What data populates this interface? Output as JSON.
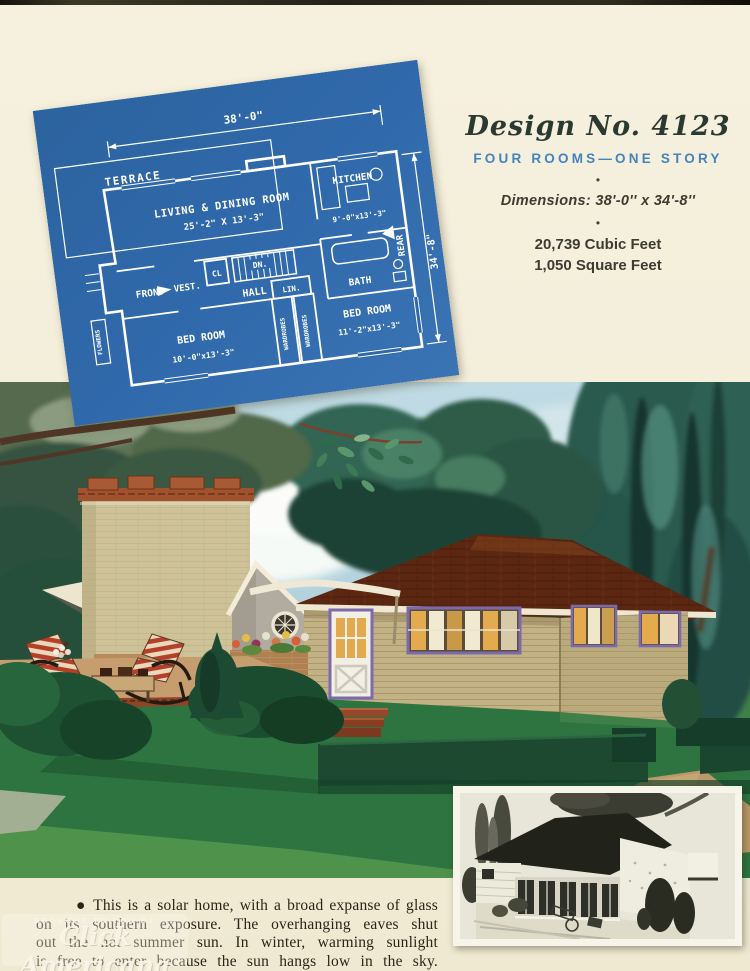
{
  "design_info": {
    "title": "Design No. 4123",
    "subtitle": "FOUR ROOMS—ONE STORY",
    "bullet": "•",
    "dimensions": "Dimensions: 38'-0'' x 34'-8''",
    "cubic_feet": "20,739 Cubic Feet",
    "square_feet": "1,050 Square Feet"
  },
  "blueprint": {
    "labels": {
      "terrace": "TERRACE",
      "width_dim": "38'-0\"",
      "living": "LIVING & DINING ROOM",
      "living_dim": "25'-2\" X 13'-3\"",
      "kitchen": "KITCHEN",
      "kitchen_dim": "9'-0\"x13'-3\"",
      "rear": "REAR",
      "height_dim": "34'-8\"",
      "front": "FRONT",
      "vest": "VEST.",
      "cl": "CL",
      "dn": "DN.",
      "hall": "HALL",
      "bath": "BATH",
      "lin": "LIN.",
      "wardrobes_left": "WARDROBES",
      "wardrobes_right": "WARDROBES",
      "bedroom_left": "BED ROOM",
      "bedroom_left_dim": "10'-0\"x13'-3\"",
      "bedroom_right": "BED ROOM",
      "bedroom_right_dim": "11'-2\"x13'-3\"",
      "flowers": "FLOWERS"
    }
  },
  "caption": {
    "lines": [
      "● This is a solar home, with a broad expanse of glass",
      "on its southern exposure. The overhanging eaves shut",
      "out the hot summer sun. In winter, warming sunlight",
      "is free to enter because the sun hangs low in the sky."
    ]
  },
  "watermark": {
    "line1": "BROUGHT TO YOU BY",
    "line2": "Click Americana",
    "line3": "CLICKAMERICANA.COM"
  },
  "palette": {
    "paper_cream": "#f3eeda",
    "blueprint_blue": "#3069ab",
    "accent_blue": "#4583bd",
    "title_ink": "#2b3a31",
    "text_ink": "#2c2418",
    "roof_brown": "#5c2711",
    "siding_tan": "#c3b284",
    "chimney_buff": "#cdc298",
    "window_trim_purple": "#7b6bad",
    "lawn_green": "#2e7440",
    "sky_blue": "#b9d6e0"
  }
}
